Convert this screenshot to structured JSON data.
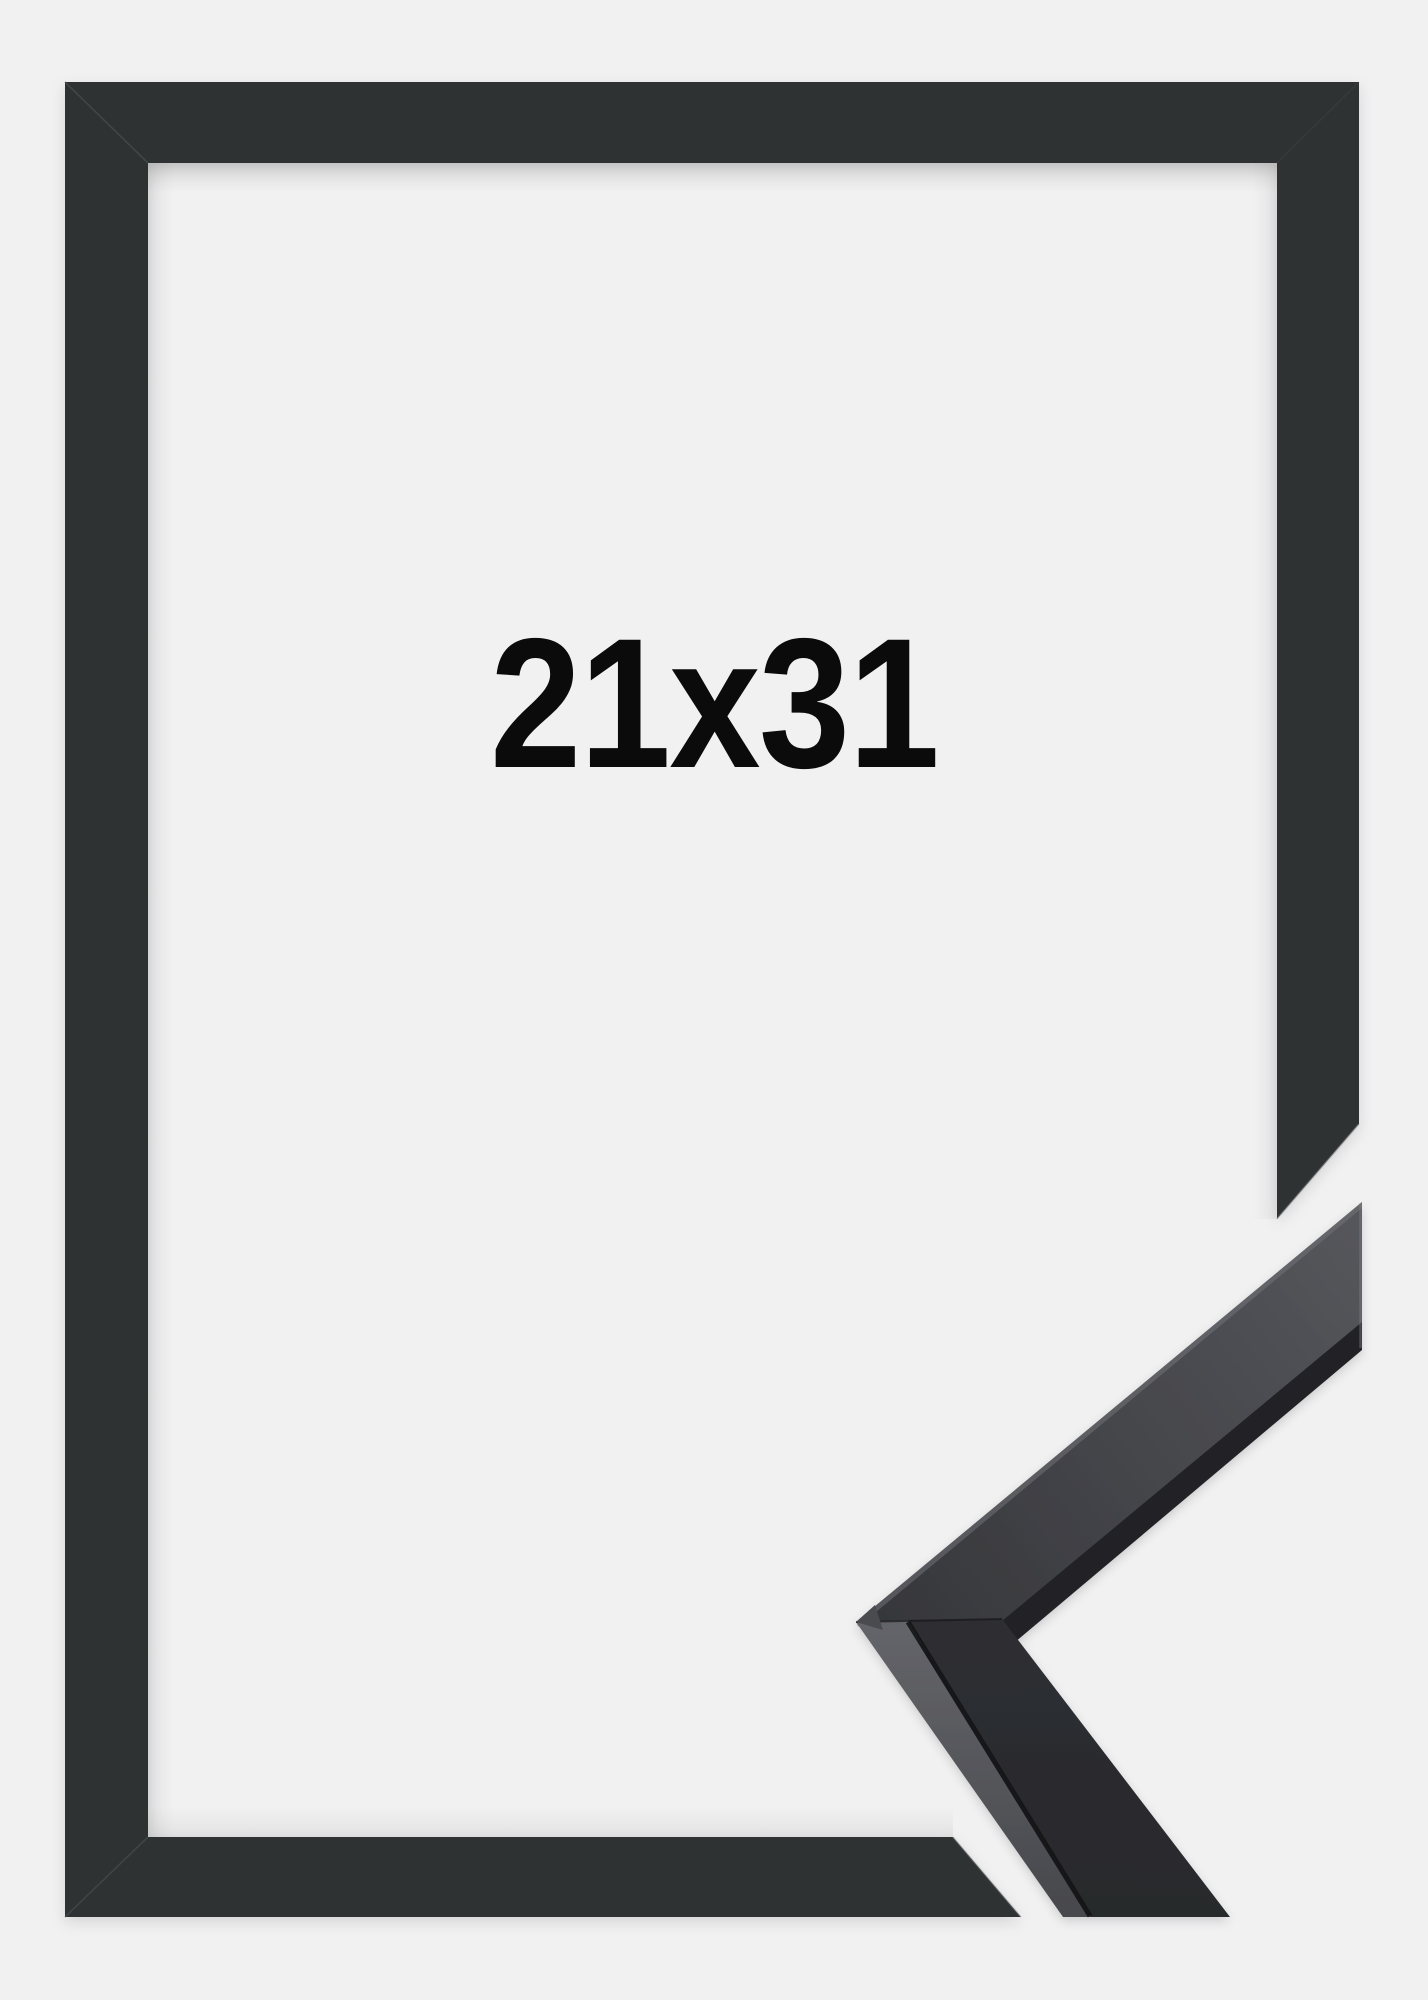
{
  "page": {
    "background_color": "#f1f1f2"
  },
  "frame_product": {
    "size_label": "21x31",
    "frame_color": "#2f3032",
    "label_color": "#0b0b0c",
    "corner_sample": {
      "upper_arm_dark_edge_color": "#232327",
      "upper_arm_face_start_color": "#36373b",
      "upper_arm_face_end_color": "#55565b",
      "lower_arm_side_top_color": "#65666b",
      "lower_arm_side_bottom_color": "#47484c",
      "lower_arm_face_color": "#2c2d30",
      "crease_color": "#121215"
    }
  }
}
